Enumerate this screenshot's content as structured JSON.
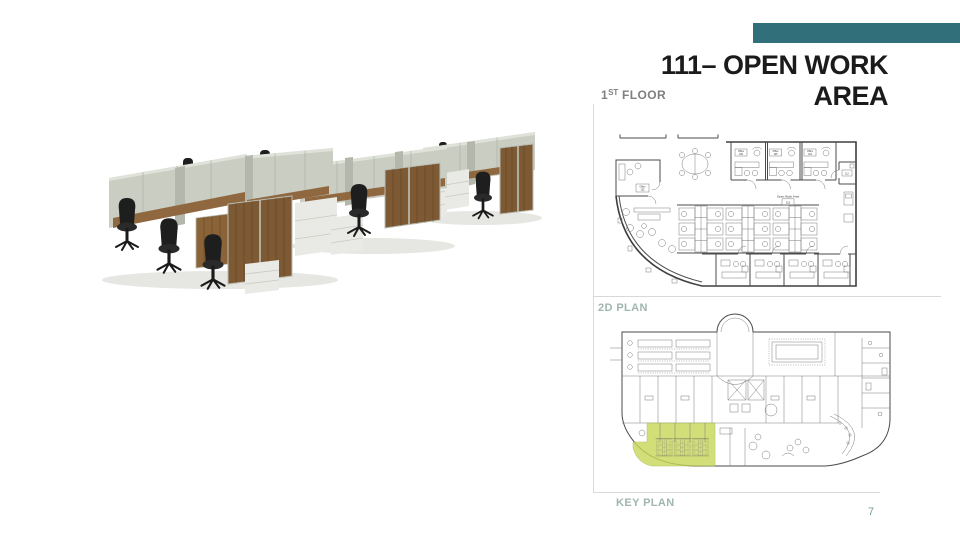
{
  "page": {
    "background": "#ffffff",
    "number": "7",
    "number_color": "#7d9a9e",
    "accent_color": "#31707b"
  },
  "title": {
    "line1": "111– OPEN WORK",
    "line2": "AREA",
    "color": "#1b1b1b"
  },
  "floor_label": {
    "number": "1",
    "ordinal": "ST",
    "text": " FLOOR",
    "color": "#7f7f7f"
  },
  "captions": {
    "plan_caption": "2D PLAN",
    "key_caption": "KEY PLAN",
    "color": "#9fb6ae"
  },
  "floor_plan": {
    "open_area_label": "Open Work Area",
    "open_area_number": "111",
    "offices_top": [
      {
        "name": "Office",
        "number": "106"
      },
      {
        "name": "Office",
        "number": "105"
      },
      {
        "name": "Office",
        "number": "104"
      }
    ],
    "office_left": {
      "name": "Office",
      "number": "102"
    },
    "room_right": {
      "number": "112"
    }
  },
  "key_plan": {
    "highlight_color": "#c9d95c"
  },
  "photo": {
    "subject": "open-plan-workstation-cubicles-render",
    "colors": {
      "panel": "#c9cdc2",
      "wood": "#7d5a34",
      "desk": "#8f6840",
      "chair": "#1e1e1e",
      "cabinet": "#e9eae5"
    }
  }
}
